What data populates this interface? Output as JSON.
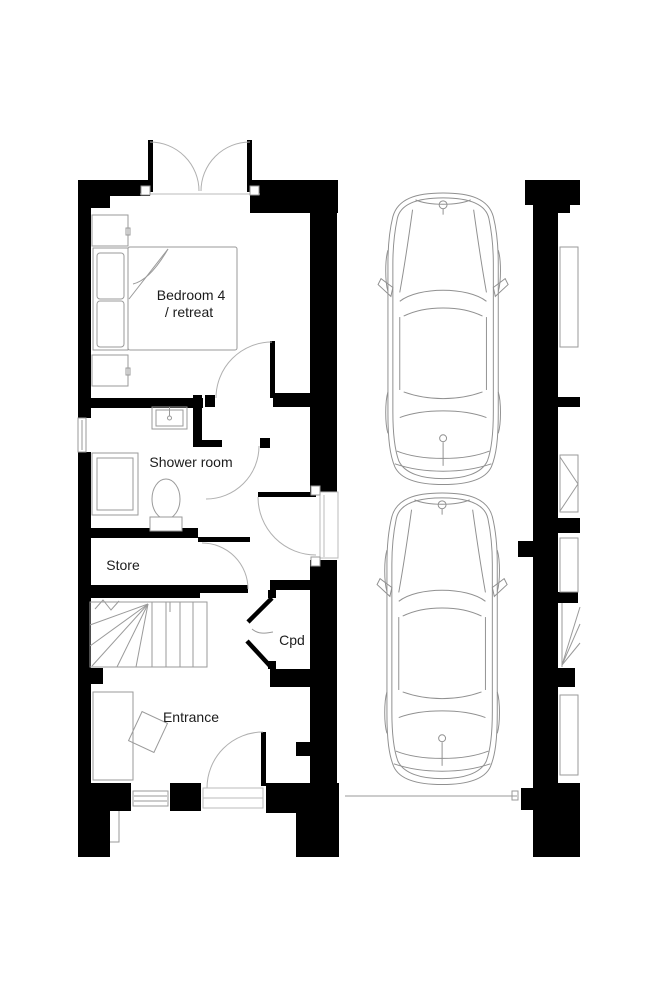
{
  "page": {
    "background": "#ffffff",
    "width": 661,
    "height": 1001
  },
  "plan": {
    "labels": {
      "bedroom_line1": "Bedroom 4",
      "bedroom_line2": "/ retreat",
      "shower_room": "Shower room",
      "store": "Store",
      "cupboard": "Cpd",
      "entrance": "Entrance"
    },
    "colors": {
      "wall": "#000000",
      "furniture_line": "#9a9a9a",
      "door_arc": "#b0b0b0",
      "car_line": "#909090",
      "label_text": "#1c1c1c"
    },
    "driveway": {
      "car_count": 2
    }
  }
}
